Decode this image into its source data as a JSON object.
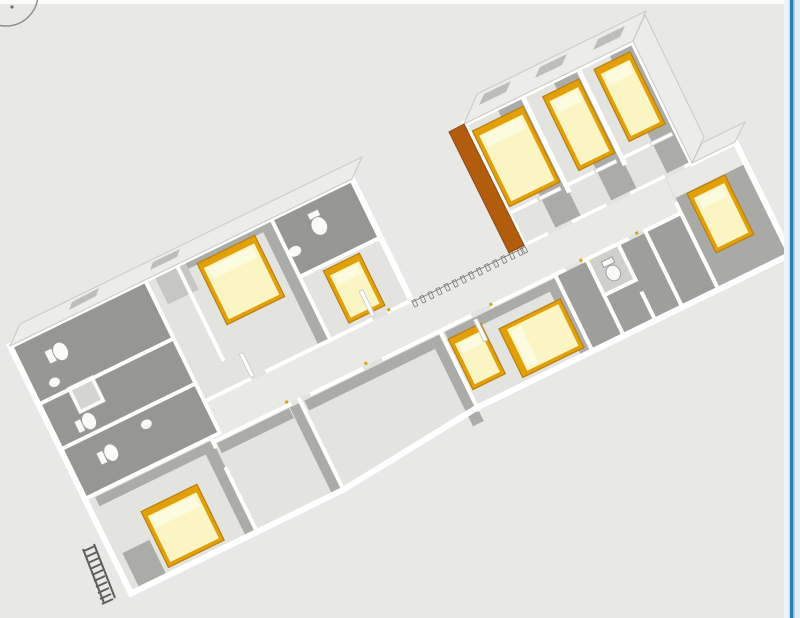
{
  "canvas": {
    "width": 800,
    "height": 618,
    "background": "#e8e8e6",
    "top_strip": "#fbfbf9"
  },
  "window_border": {
    "base": "#eff3f6",
    "outer_light": "#cfe3ef",
    "blue": "#2e7cb2",
    "inner_blue": "#8fbcd8",
    "pale": "#e2edf4"
  },
  "rotate_widget": {
    "ring": "#8e8e8a",
    "dot": "#6f6f6b"
  },
  "palette": {
    "floor": "#e3e3e0",
    "floor_lit": "#e9e9e6",
    "shadow": "#ababa8",
    "dark_room": "#969693",
    "closet": "#9e9e9b",
    "closet_light": "#cfcfcc",
    "bedroom_dark": "#a9a9a6",
    "wall": "#ffffff",
    "wall_edge": "#c9c9c6",
    "wall_face": "#ececea",
    "window_glass": "#bdbdba",
    "bed_frame": "#e2a008",
    "bed_frame_dark": "#b97f10",
    "mattress": "#fbf5c4",
    "pillow": "#fdfbdf",
    "wardrobe": "#b25d0e",
    "wardrobe_side": "#93490a",
    "fixture": "#fafaf8",
    "fixture_edge": "#9b9b98",
    "shower_inner": "#d4d4d1",
    "ladder": "#5e5e5a",
    "railing": "#e8e8e4",
    "railing_edge": "#6f6f6b",
    "light_patch": "#c6c6c3",
    "handle": "#d9a610"
  },
  "scene": {
    "kind": "isometric-3d-floorplan",
    "rooms": [
      "bathroom-suite-west",
      "bedroom-southwest",
      "living-room-1",
      "living-room-2",
      "bedroom-west",
      "hall-bathroom",
      "bedroom-small",
      "corridor",
      "open-walkway",
      "bedroom-north-1",
      "bedroom-north-2",
      "bedroom-north-3",
      "storage-closets",
      "closet-wc",
      "bedroom-east"
    ],
    "furniture": {
      "beds": [
        {
          "id": "bed-north-1",
          "size": "double"
        },
        {
          "id": "bed-north-2",
          "size": "single"
        },
        {
          "id": "bed-north-3",
          "size": "single"
        },
        {
          "id": "bed-east",
          "size": "single"
        },
        {
          "id": "bed-center-single",
          "size": "single"
        },
        {
          "id": "bed-center-double",
          "size": "double"
        },
        {
          "id": "bed-west",
          "size": "double"
        },
        {
          "id": "bed-small-room",
          "size": "single"
        },
        {
          "id": "bed-southwest",
          "size": "double"
        }
      ],
      "wardrobe_panels": 1,
      "toilets": 5,
      "sinks": 3,
      "showers": 1,
      "ladder_rungs": 10,
      "railing_posts": 15
    }
  }
}
